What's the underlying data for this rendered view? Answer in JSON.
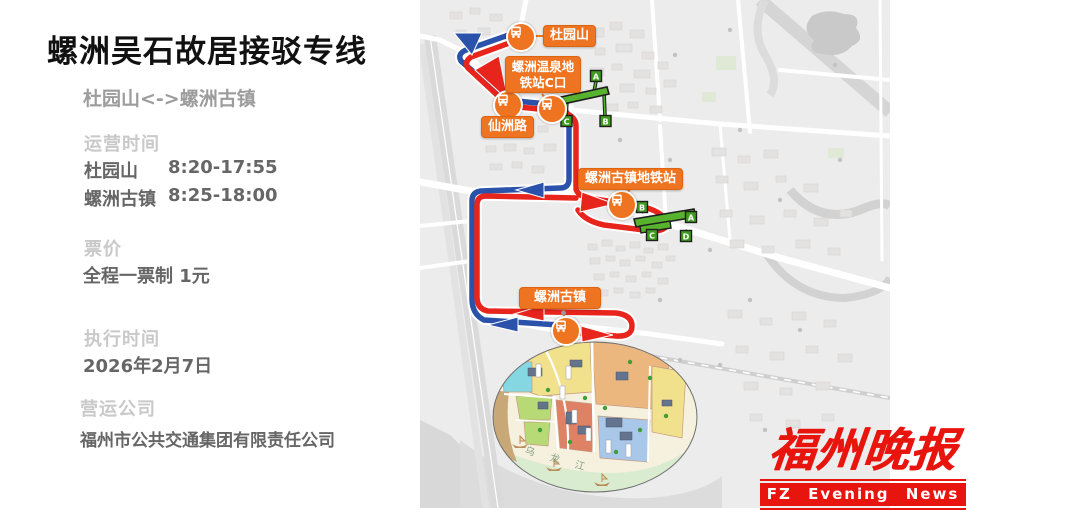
{
  "panel": {
    "title": "螺洲吴石故居接驳专线",
    "subtitle": "杜园山<->螺洲古镇",
    "operating": {
      "label": "运营时间",
      "rows": [
        {
          "place": "杜园山",
          "time": "8:20-17:55"
        },
        {
          "place": "螺洲古镇",
          "time": "8:25-18:00"
        }
      ]
    },
    "fare": {
      "label": "票价",
      "value": "全程一票制 1元"
    },
    "effective": {
      "label": "执行时间",
      "value": "2026年2月7日"
    },
    "company": {
      "label": "营运公司",
      "value": "福州市公共交通集团有限责任公司"
    }
  },
  "map": {
    "stops": {
      "duyuanshan": "杜园山",
      "wenquan": "螺洲温泉地铁站C口",
      "xianzhoulu": "仙洲路",
      "guzhen_metro": "螺洲古镇地铁站",
      "guzhen": "螺洲古镇"
    },
    "station1_exits": [
      "A",
      "C",
      "B"
    ],
    "station2_exits": [
      "B",
      "A",
      "C",
      "D"
    ],
    "river_label": "乌龙江",
    "colors": {
      "route_outbound_red": "#e8251c",
      "route_return_blue": "#2a52aa",
      "stop_orange": "#ee7421",
      "metro_green": "#57b32e"
    }
  },
  "logo": {
    "cn": "福州晚报",
    "en": "FZ Evening News"
  }
}
